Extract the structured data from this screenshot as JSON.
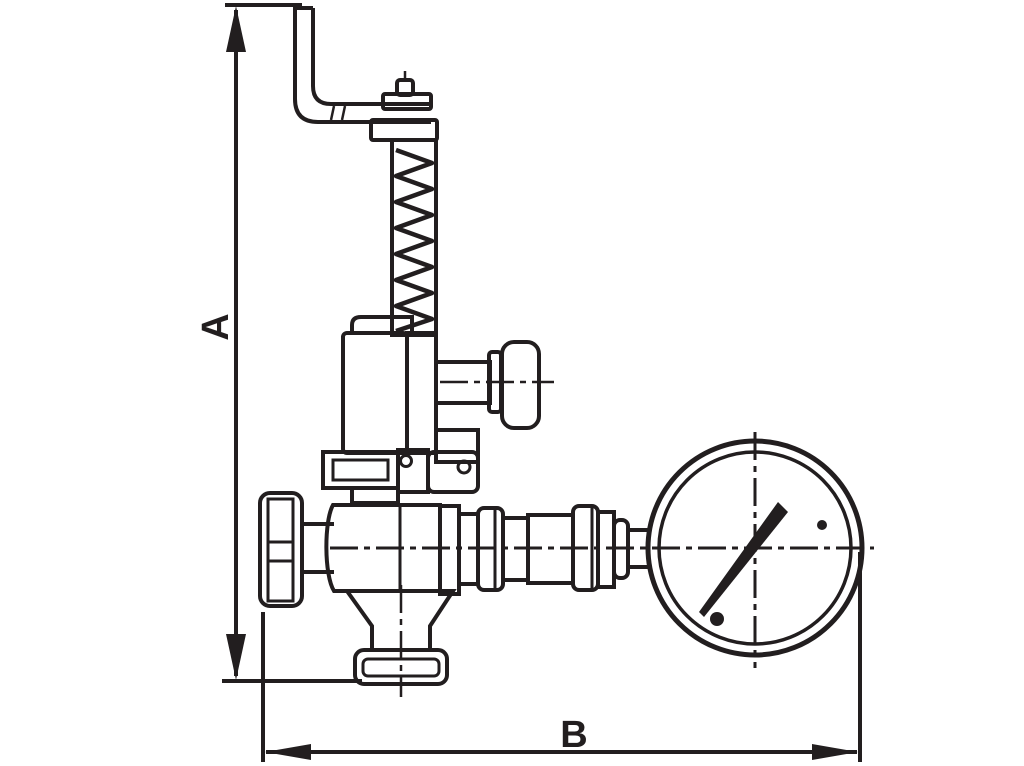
{
  "page": {
    "background_color": "#ffffff",
    "ink_color": "#221e1f"
  },
  "drawing": {
    "kind": "technical-dimension-drawing",
    "subject": "spring-loaded relief valve assembly with handwheel and pressure gauge",
    "components": [
      "bent-lever-arm",
      "adjusting-cap",
      "compression-spring-housing",
      "spring-bonnet",
      "side-test-knob",
      "body-flange",
      "handwheel",
      "valve-body",
      "outlet-couplings",
      "bottom-flange",
      "pressure-gauge",
      "gauge-needle"
    ]
  },
  "dimensions": {
    "vertical_label": "A",
    "horizontal_label": "B"
  }
}
